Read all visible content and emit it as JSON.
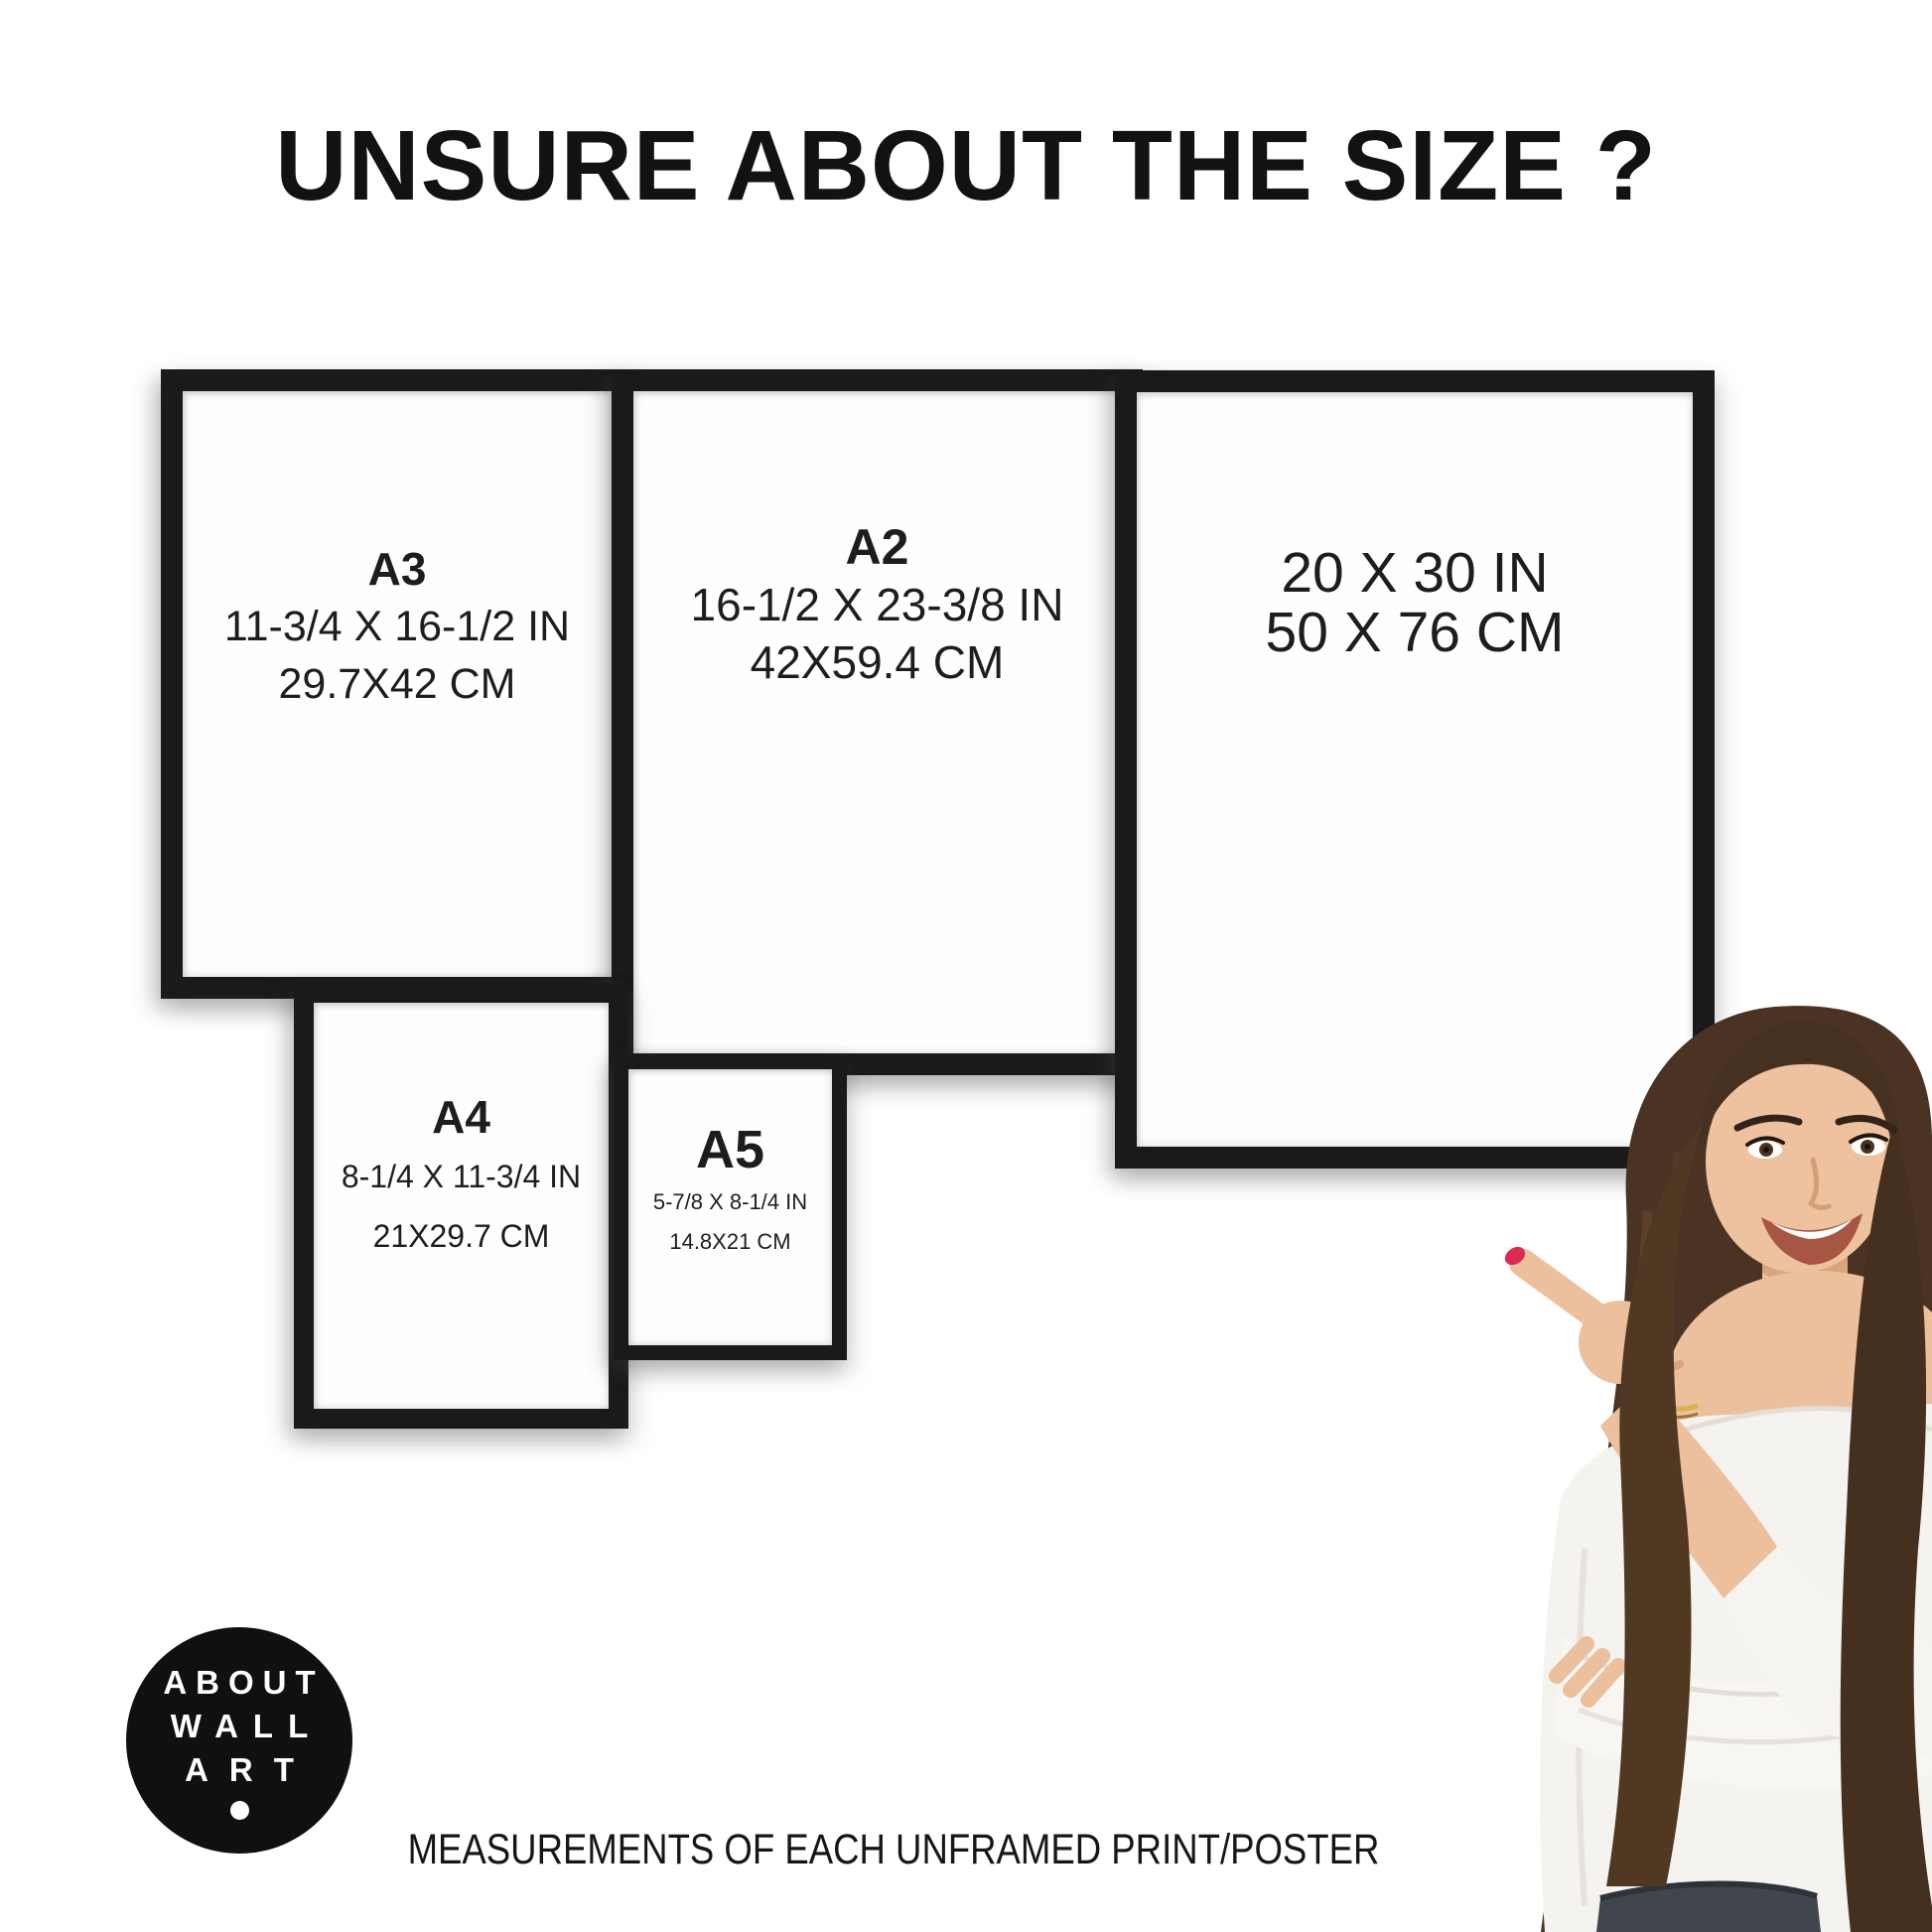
{
  "page": {
    "title": "UNSURE ABOUT THE SIZE ?",
    "caption": "MEASUREMENTS OF EACH UNFRAMED PRINT/POSTER"
  },
  "frames": [
    {
      "name": "A3",
      "inches": "11-3/4 X 16-1/2 IN",
      "cm": "29.7X42 CM"
    },
    {
      "name": "A2",
      "inches": "16-1/2 X 23-3/8 IN",
      "cm": "42X59.4 CM"
    },
    {
      "name": "",
      "inches": "20 X 30 IN",
      "cm": "50 X 76 CM"
    },
    {
      "name": "A4",
      "inches": "8-1/4 X 11-3/4 IN",
      "cm": "21X29.7 CM"
    },
    {
      "name": "A5",
      "inches": "5-7/8 X 8-1/4 IN",
      "cm": "14.8X21 CM"
    }
  ],
  "logo": {
    "lines": [
      "ABOUT",
      "WALL",
      "ART"
    ],
    "dot_icon": "circle-dot"
  },
  "colors": {
    "background": "#ffffff",
    "frame_black": "#1a1a1a",
    "text": "#1d1d1d",
    "logo_black": "#101010",
    "hair_brown": "#4a3322",
    "skin": "#ecbf9d",
    "blouse_white": "#f5f3ef",
    "nail_red": "#dd2a52",
    "jeans": "#40454e"
  }
}
